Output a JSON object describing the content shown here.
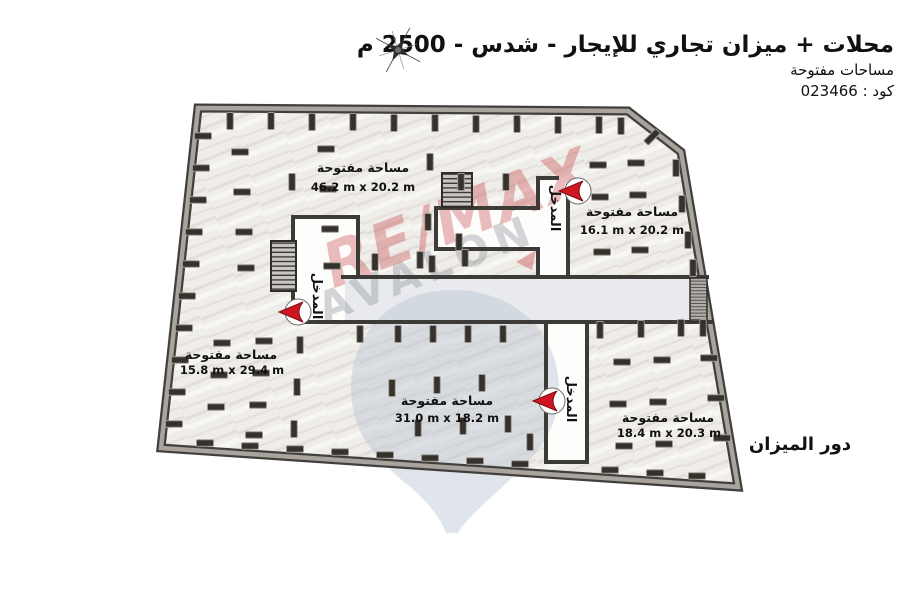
{
  "header": {
    "title": "محلات + ميزان تجاري للإيجار - شدس - 2500 م",
    "subtitle": "مساحات مفتوحة",
    "code": "كود : 023466"
  },
  "plan": {
    "floor_label": "دور الميزان",
    "entrance_label": "المدخل",
    "zones": [
      {
        "name": "مساحة مفتوحة",
        "dims": "46.2 m x 20.2 m",
        "position": "top-left"
      },
      {
        "name": "مساحة مفتوحة",
        "dims": "16.1 m x 20.2 m",
        "position": "top-right"
      },
      {
        "name": "مساحة مفتوحة",
        "dims": "15.8 m x 29.4 m",
        "position": "left"
      },
      {
        "name": "مساحة مفتوحة",
        "dims": "31.0 m x 18.2 m",
        "position": "bottom-middle"
      },
      {
        "name": "مساحة مفتوحة",
        "dims": "18.4 m x 20.3 m",
        "position": "bottom-right"
      }
    ]
  },
  "watermark": {
    "brand": "RE/MAX",
    "name": "AVALON"
  },
  "colors": {
    "arrow_red": "#cf1620",
    "wall_dark": "#3d3b38",
    "outer_wall_gray": "#a9a49d",
    "band_fill": "#e8eaed",
    "corridor_fill": "#fdfdfc",
    "floor_fill": "#efede9",
    "balloon_watermark": "#b4c1d2"
  }
}
